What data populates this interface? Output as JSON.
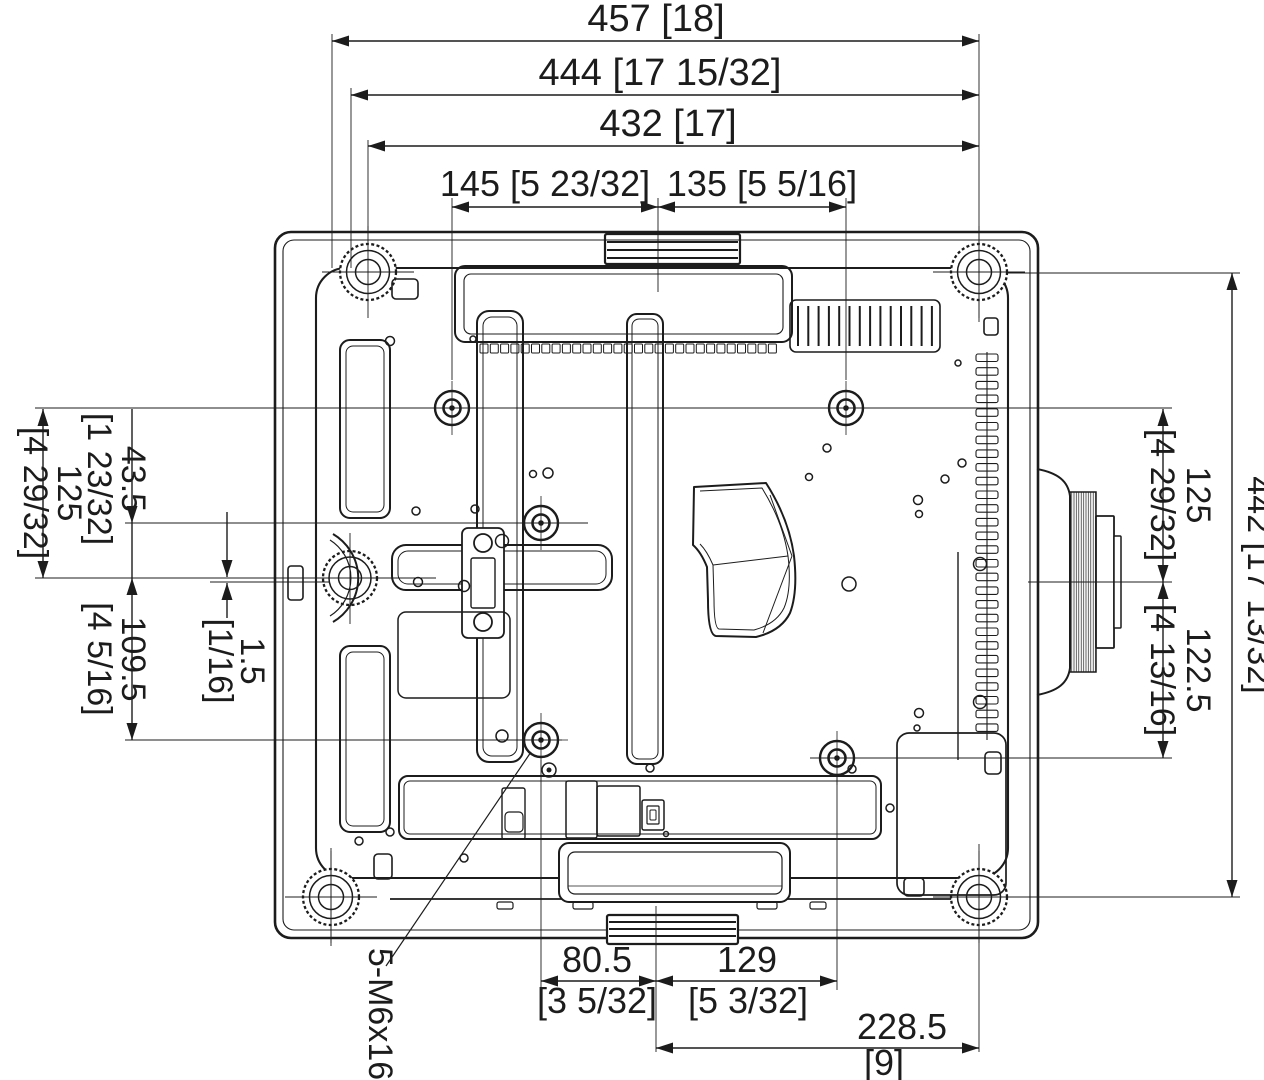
{
  "page": {
    "background": "#ffffff",
    "line_color": "#1c1c1c"
  },
  "drawing": {
    "type": "technical-dimension-diagram",
    "subject": "projector bottom view — mounting dimensions (mm [inches])",
    "screw_note": {
      "label": "5-M6x16"
    },
    "dimensions": [
      {
        "id": "width_overall",
        "value": "457",
        "bracket": "[18]"
      },
      {
        "id": "width_outer",
        "value": "444",
        "bracket": "[17 15/32]"
      },
      {
        "id": "width_feet",
        "value": "432",
        "bracket": "[17]"
      },
      {
        "id": "top_hole_left_to_center",
        "value": "145",
        "bracket": "[5 23/32]"
      },
      {
        "id": "top_center_to_right_hole",
        "value": "135",
        "bracket": "[5 5/16]"
      },
      {
        "id": "left_hole_to_foot",
        "value": "125",
        "bracket": "[4 29/32]"
      },
      {
        "id": "left_center_hole_to_foot",
        "value": "43.5",
        "bracket": "[1 23/32]"
      },
      {
        "id": "left_foot_to_bottom_hole",
        "value": "109.5",
        "bracket": "[4 5/16]"
      },
      {
        "id": "left_centerline_offset",
        "value": "1.5",
        "bracket": "[1/16]"
      },
      {
        "id": "right_hole_to_lens",
        "value": "125",
        "bracket": "[4 29/32]"
      },
      {
        "id": "right_lens_to_bottom_hole",
        "value": "122.5",
        "bracket": "[4 13/16]"
      },
      {
        "id": "depth_feet",
        "value": "442",
        "bracket": "[17 13/32]"
      },
      {
        "id": "bottom_hole_to_center",
        "value": "80.5",
        "bracket": "[3 5/32]"
      },
      {
        "id": "bottom_center_to_right_hole",
        "value": "129",
        "bracket": "[5 3/32]"
      },
      {
        "id": "bottom_center_to_foot",
        "value": "228.5",
        "bracket": "[9]"
      }
    ]
  }
}
